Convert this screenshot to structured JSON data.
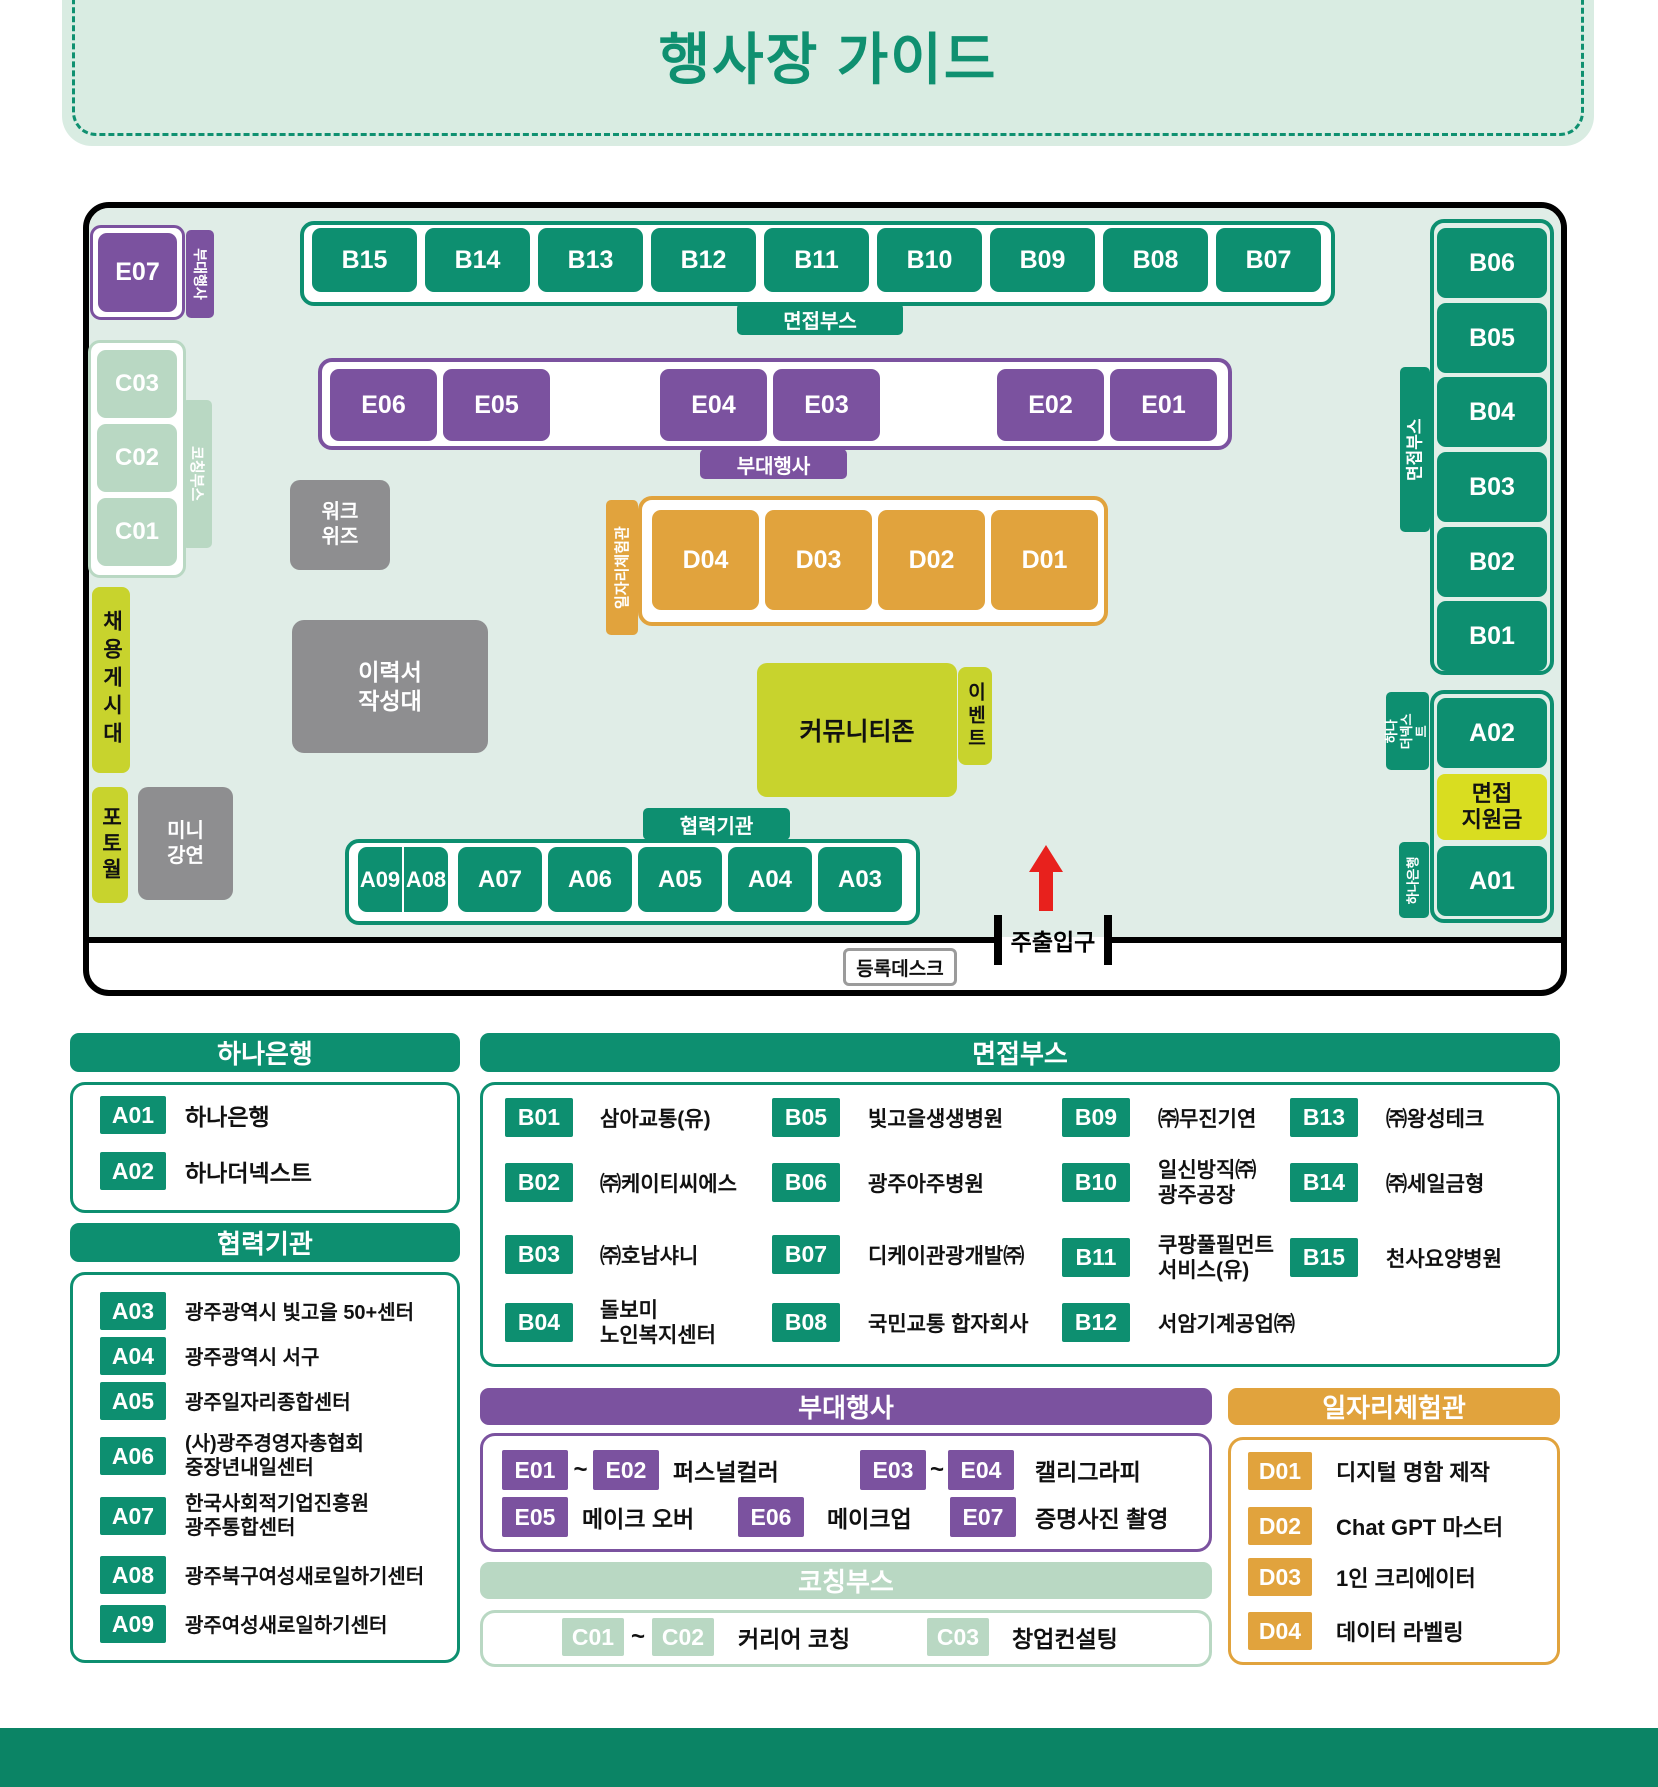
{
  "title": "행사장 가이드",
  "colors": {
    "green": "#0d8f70",
    "light_green": "#b9d8c3",
    "purple": "#7b529f",
    "orange": "#e1a33d",
    "lime": "#c8d32d",
    "lime_bright": "#d9dd20",
    "gray": "#8e8e90",
    "floor": "#e0ede7",
    "footer": "#0b8465",
    "arrow_red": "#e8211d"
  },
  "map": {
    "booths_top": [
      "B15",
      "B14",
      "B13",
      "B12",
      "B11",
      "B10",
      "B09",
      "B08",
      "B07"
    ],
    "booths_right": [
      "B06",
      "B05",
      "B04",
      "B03",
      "B02",
      "B01"
    ],
    "e07": "E07",
    "e_row": [
      "E06",
      "E05",
      "E04",
      "E03",
      "E02",
      "E01"
    ],
    "c_col": [
      "C03",
      "C02",
      "C01"
    ],
    "d_row": [
      "D04",
      "D03",
      "D02",
      "D01"
    ],
    "a_row": [
      "A09",
      "A08",
      "A07",
      "A06",
      "A05",
      "A04",
      "A03"
    ],
    "a02": "A02",
    "a01": "A01",
    "tags": {
      "interview_top": "면접부스",
      "interview_right": "면접부스",
      "side_event_small": "부대행사",
      "side_event": "부대행사",
      "partner": "협력기관",
      "coaching": "코칭부스",
      "job_experience": "일자리체험관",
      "hana_the_next": "하나\n더넥스트",
      "hana_bank": "하나은행"
    },
    "areas": {
      "workwiz": "워크\n위즈",
      "resume_desk": "이력서\n작성대",
      "community_zone": "커뮤니티존",
      "event": "이벤트",
      "job_board": "채용게시대",
      "photo_wall": "포토월",
      "mini_lecture": "미니\n강연",
      "interview_support": "면접\n지원금"
    },
    "entrance": "주출입구",
    "registration_desk": "등록데스크"
  },
  "legend": {
    "hana": {
      "header": "하나은행",
      "items": [
        {
          "code": "A01",
          "name": "하나은행"
        },
        {
          "code": "A02",
          "name": "하나더넥스트"
        }
      ]
    },
    "partners": {
      "header": "협력기관",
      "items": [
        {
          "code": "A03",
          "name": "광주광역시 빛고을 50+센터"
        },
        {
          "code": "A04",
          "name": "광주광역시 서구"
        },
        {
          "code": "A05",
          "name": "광주일자리종합센터"
        },
        {
          "code": "A06",
          "name": "(사)광주경영자총협회\n중장년내일센터"
        },
        {
          "code": "A07",
          "name": "한국사회적기업진흥원\n광주통합센터"
        },
        {
          "code": "A08",
          "name": "광주북구여성새로일하기센터"
        },
        {
          "code": "A09",
          "name": "광주여성새로일하기센터"
        }
      ]
    },
    "interview": {
      "header": "면접부스",
      "items": [
        {
          "code": "B01",
          "name": "삼아교통(유)"
        },
        {
          "code": "B02",
          "name": "㈜케이티씨에스"
        },
        {
          "code": "B03",
          "name": "㈜호남샤니"
        },
        {
          "code": "B04",
          "name": "돌보미\n노인복지센터"
        },
        {
          "code": "B05",
          "name": "빛고을생생병원"
        },
        {
          "code": "B06",
          "name": "광주아주병원"
        },
        {
          "code": "B07",
          "name": "디케이관광개발㈜"
        },
        {
          "code": "B08",
          "name": "국민교통 합자회사"
        },
        {
          "code": "B09",
          "name": "㈜무진기연"
        },
        {
          "code": "B10",
          "name": "일신방직㈜\n광주공장"
        },
        {
          "code": "B11",
          "name": "쿠팡풀필먼트\n서비스(유)"
        },
        {
          "code": "B12",
          "name": "서암기계공업㈜"
        },
        {
          "code": "B13",
          "name": "㈜왕성테크"
        },
        {
          "code": "B14",
          "name": "㈜세일금형"
        },
        {
          "code": "B15",
          "name": "천사요양병원"
        }
      ]
    },
    "side_events": {
      "header": "부대행사",
      "tilde": "~",
      "rows": [
        {
          "c1": "E01",
          "c2": "E02",
          "name": "퍼스널컬러"
        },
        {
          "c1": "E03",
          "c2": "E04",
          "name": "캘리그라피"
        },
        {
          "c": "E05",
          "name": "메이크 오버"
        },
        {
          "c": "E06",
          "name": "메이크업"
        },
        {
          "c": "E07",
          "name": "증명사진 촬영"
        }
      ]
    },
    "coaching": {
      "header": "코칭부스",
      "tilde": "~",
      "rows": [
        {
          "c1": "C01",
          "c2": "C02",
          "name": "커리어 코칭"
        },
        {
          "c": "C03",
          "name": "창업컨설팅"
        }
      ]
    },
    "job_experience": {
      "header": "일자리체험관",
      "items": [
        {
          "code": "D01",
          "name": "디지털 명함 제작"
        },
        {
          "code": "D02",
          "name": "Chat GPT 마스터"
        },
        {
          "code": "D03",
          "name": "1인 크리에이터"
        },
        {
          "code": "D04",
          "name": "데이터 라벨링"
        }
      ]
    }
  }
}
